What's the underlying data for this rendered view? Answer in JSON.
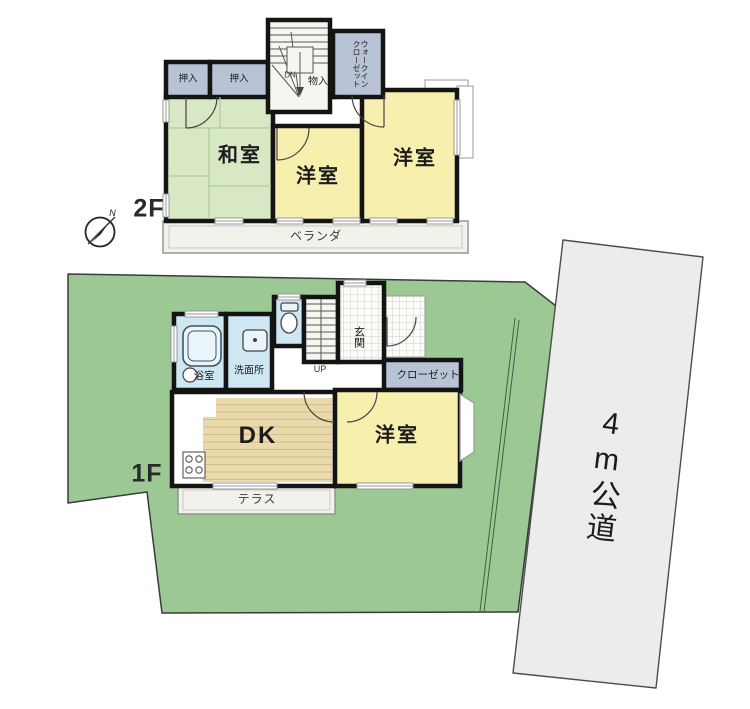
{
  "site": {
    "compass_north_label": "N",
    "road_label": "4m公道",
    "colors": {
      "plot_green": "#9cc894",
      "road_gray": "#ececec",
      "wall_black": "#141414",
      "tatami_green": "#d8e7c4",
      "room_yellow": "#f6efad",
      "closet_gray_blue": "#b9c3d6",
      "water_blue": "#cfe7f2",
      "wood_floor": "#ead9ab"
    }
  },
  "floor2": {
    "floor_label": "2F",
    "rooms": {
      "oshiire_left": "押入",
      "oshiire_right": "押入",
      "stairs_down": "DN",
      "monoire": "物入",
      "walk_in_closet": "ウォークイン\nクローゼット",
      "washitsu": "和室",
      "youshitsu_center": "洋室",
      "youshitsu_right": "洋室",
      "veranda": "ベランダ"
    }
  },
  "floor1": {
    "floor_label": "1F",
    "rooms": {
      "bath": "浴室",
      "washroom": "洗面所",
      "stairs_up": "UP",
      "entrance": "玄関",
      "closet": "クローゼット",
      "dining_kitchen": "DK",
      "youshitsu": "洋室",
      "terrace": "テラス"
    }
  }
}
